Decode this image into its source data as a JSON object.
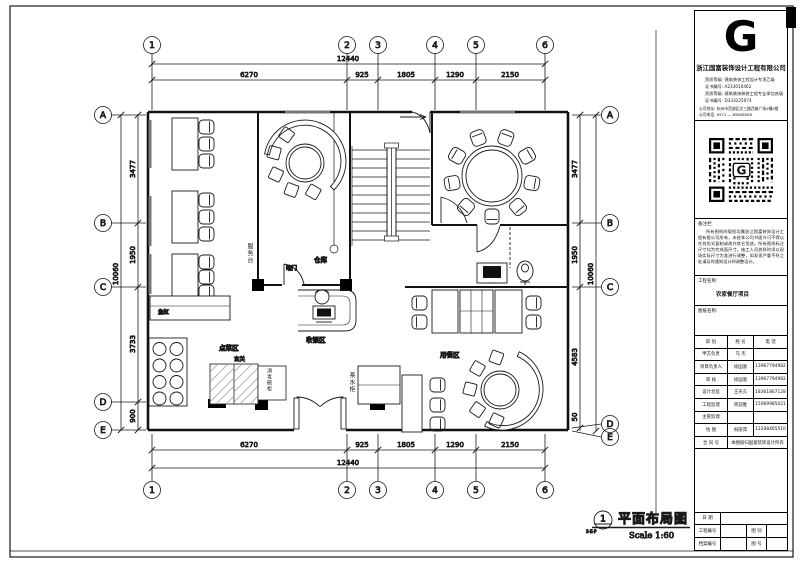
{
  "page": {
    "sheet_title": "平面布局图",
    "scale": "Scale 1:60",
    "view_number": "1",
    "view_ref": "S-E-P"
  },
  "plan": {
    "grid_cols": [
      "1",
      "2",
      "3",
      "4",
      "5",
      "6"
    ],
    "grid_rows": [
      "A",
      "B",
      "C",
      "D",
      "E"
    ],
    "dims": {
      "total_h": "12440",
      "h": [
        "6270",
        "925",
        "1805",
        "1290",
        "2150"
      ],
      "total_v": "10060",
      "v_left": [
        "3477",
        "1950",
        "3733",
        "900"
      ],
      "v_right": [
        "3477",
        "1950",
        "4583",
        "50"
      ]
    },
    "labels": {
      "service_desk": "服务台",
      "hidden_door": "暗门",
      "storage": "仓库",
      "cashier": "收银区",
      "fish_tank": "鱼缸",
      "ordering": "点菜区",
      "foyer": "玄关",
      "sanitizer": "消毒碗柜",
      "tea_cabinet": "茶水柜",
      "dining": "用餐区"
    }
  },
  "title_block": {
    "logo_letter": "G",
    "company": "浙江国富装饰设计工程有限公司",
    "credentials": [
      {
        "label": "资质等级:",
        "value": "建筑装饰工程设计专项乙级"
      },
      {
        "label": "证书编号:",
        "value": "A233010462"
      },
      {
        "label": "资质等级:",
        "value": "建筑装饰装修工程专业承包贰级"
      },
      {
        "label": "证书编号:",
        "value": "D333225074"
      }
    ],
    "address": {
      "label": "公司地址:",
      "value": "杭州市西湖区文三路西城广场2幢5楼"
    },
    "phone": {
      "label": "公司电话:",
      "value": "0571 — 85858508"
    },
    "notes_title": "备注栏",
    "notes_body": "所有图纸的版权均属浙江国富装饰设计工程有限公司所有，未经本公司书面许可不得以任何形式复制或改作其它用途。所有图纸标注尺寸均为完成面尺寸，施工人员放样时须以现场实际尺寸为准进行调整，如发现严重不符之处请及时通知设计师调整设计。",
    "project_label": "工程名称:",
    "project_name": "农家餐厅项目",
    "drawing_label": "图纸名称:",
    "personnel": {
      "header": [
        "职  别",
        "姓  名",
        "电  话"
      ],
      "rows": [
        {
          "role": "甲方负责",
          "name": "马 杰",
          "phone": ""
        },
        {
          "role": "项目负责人",
          "name": "徐国富",
          "phone": "13967794982"
        },
        {
          "role": "审  核",
          "name": "徐国富",
          "phone": "13967794982"
        },
        {
          "role": "设计总监",
          "name": "王天久",
          "phone": "18361867128"
        },
        {
          "role": "工程监理",
          "name": "周迎胜",
          "phone": "15069985021"
        },
        {
          "role": "主管监理",
          "name": "",
          "phone": ""
        },
        {
          "role": "绘  图",
          "name": "祝丽萍",
          "phone": "12208465510"
        }
      ],
      "contract_label": "合  同  号",
      "contract_note": "本图纸归国富装饰设计所有"
    },
    "footer_rows": {
      "date_label": "日  期",
      "project_no_label": "工程编号",
      "type_label": "图  别",
      "file_no_label": "档案编号",
      "sheet_no_label": "图  号"
    }
  }
}
